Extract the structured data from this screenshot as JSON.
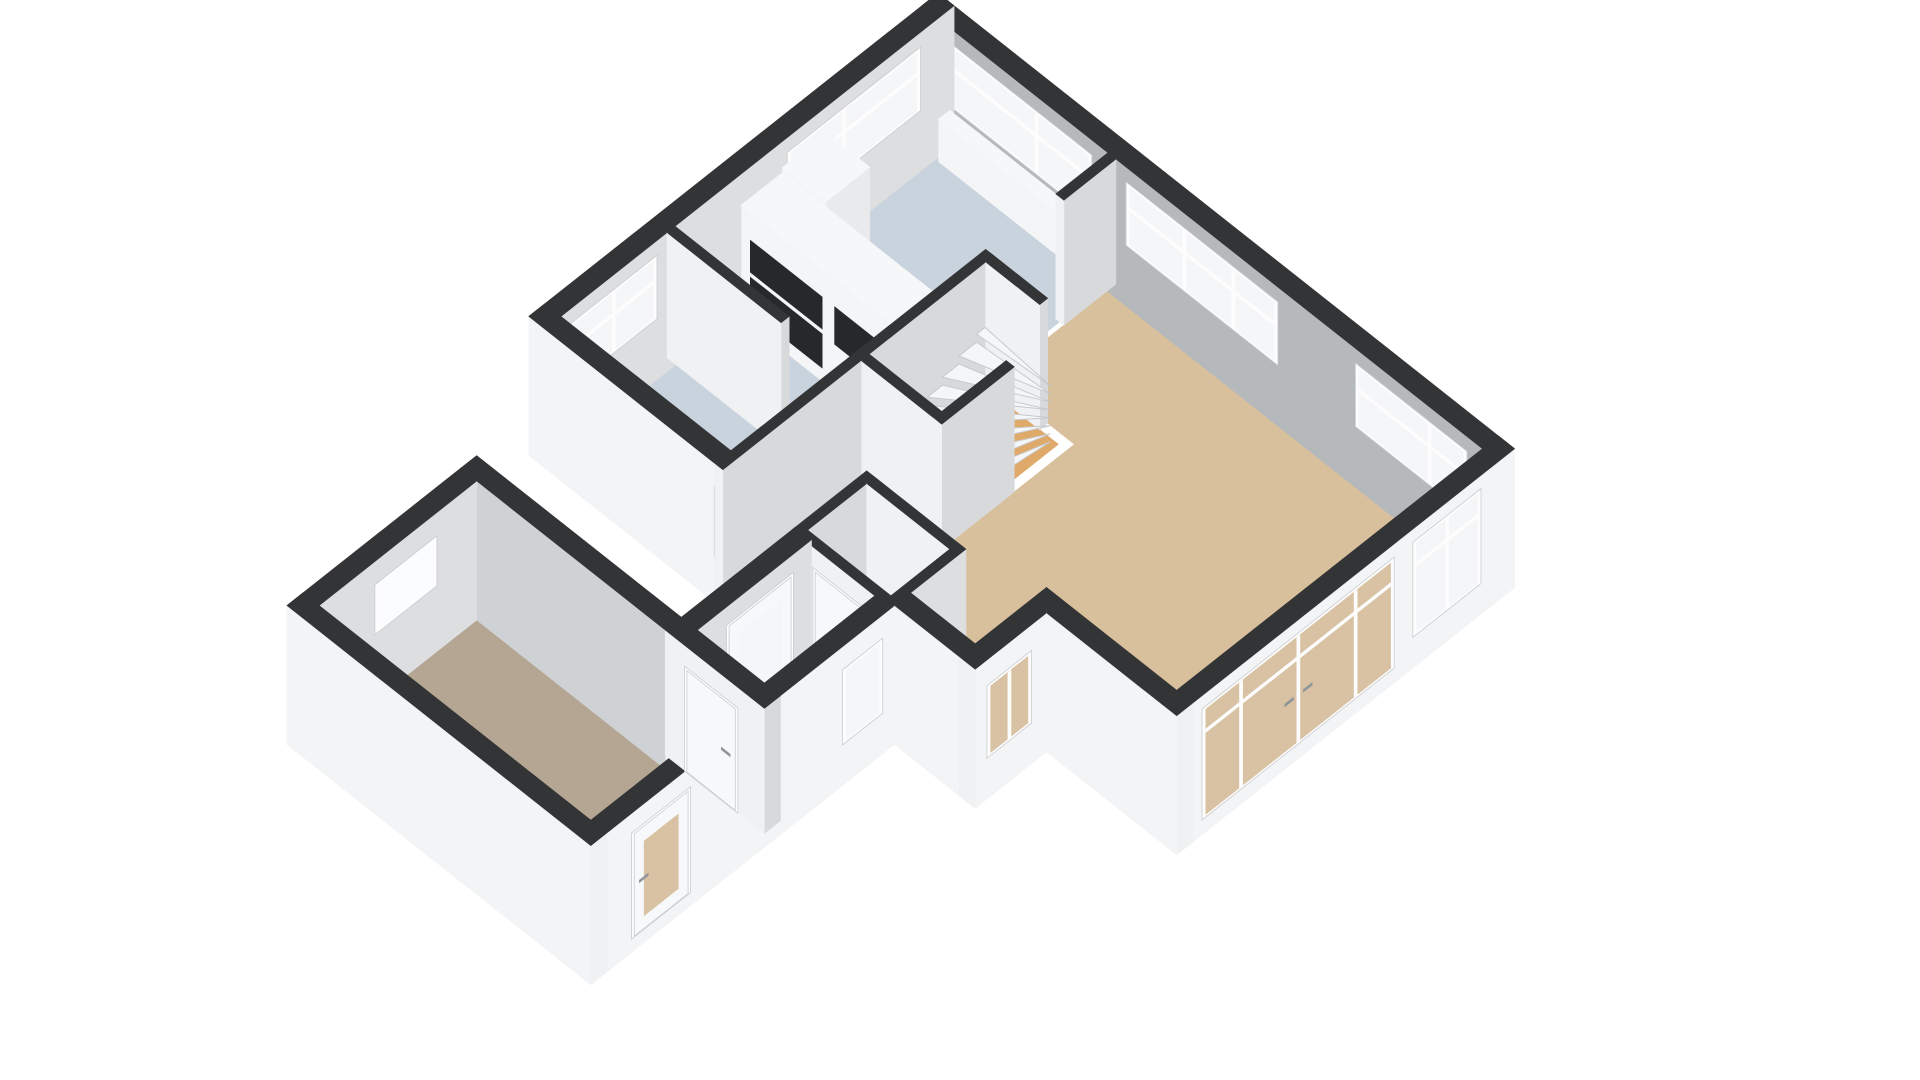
{
  "meta": {
    "type": "3d-floorplan-render",
    "view": "isometric-from-south-west",
    "background": "#ffffff",
    "floor_shown": "ground-floor"
  },
  "palette": {
    "wall_top": "#333436",
    "exterior_wall": "#f3f4f5",
    "exterior_wall_end": "#f0f1f2",
    "interior_shadow": "#b6b9bc",
    "interior_light": "#dcdee0",
    "partition_lit": "#f0f1f2",
    "partition_shade": "#d7d9db",
    "garage_interior": "#cfd2d4",
    "floor_living": "#d9c09c",
    "floor_wet": "#c9d3de",
    "floor_stairs": "#dfa96a",
    "floor_garage": "#b5a693",
    "glass_clear": "#f4f6f8",
    "glass_bright": "#fbfcfd",
    "glass_tan": "#d8c2a3",
    "glass_dark": "#41464b",
    "frame": "#fdfdfe",
    "frame_stroke": "#c9ccce",
    "door_panel": "#f7f8f9",
    "handle": "#8e9499",
    "tread": "#f5f6f7",
    "tread_stroke": "#c6c9cc",
    "cabinet_front": "#f4f5f6",
    "cabinet_side": "#e8eaec",
    "cabinet_top": "#f6f7f8",
    "appliance_dark": "#26282a"
  },
  "scene": {
    "projection": {
      "ox": 938,
      "oy": 118,
      "ax": 0.62,
      "by": 0.49,
      "cz": 0.5,
      "wall_h": 250,
      "slab": -28
    },
    "rooms": [
      {
        "name": "living-room",
        "floor": "floor_living"
      },
      {
        "name": "kitchen",
        "floor": "floor_wet"
      },
      {
        "name": "pantry",
        "floor": "floor_wet"
      },
      {
        "name": "hallway",
        "floor": "floor_wet"
      },
      {
        "name": "entry-hall",
        "floor": "floor_wet"
      },
      {
        "name": "toilet",
        "floor": "floor_wet"
      },
      {
        "name": "stairwell",
        "floor": "floor_stairs"
      },
      {
        "name": "garage",
        "floor": "floor_garage"
      }
    ],
    "floors": [
      {
        "name": "floor-living-room",
        "color": "floor_living",
        "pts": [
          [
            313,
            26
          ],
          [
            904,
            26
          ],
          [
            904,
            519
          ],
          [
            694,
            519
          ],
          [
            694,
            634
          ],
          [
            590,
            634
          ],
          [
            590,
            545
          ],
          [
            443,
            545
          ],
          [
            443,
            223
          ],
          [
            313,
            223
          ]
        ]
      },
      {
        "name": "floor-kitchen",
        "color": "floor_wet",
        "pts": [
          [
            26,
            26
          ],
          [
            306,
            26
          ],
          [
            306,
            450
          ],
          [
            26,
            450
          ]
        ]
      },
      {
        "name": "floor-pantry",
        "color": "floor_wet",
        "pts": [
          [
            26,
            463
          ],
          [
            306,
            463
          ],
          [
            306,
            634
          ],
          [
            26,
            634
          ]
        ]
      },
      {
        "name": "floor-hallway",
        "color": "floor_wet",
        "pts": [
          [
            313,
            437
          ],
          [
            430,
            437
          ],
          [
            430,
            634
          ],
          [
            313,
            634
          ]
        ]
      },
      {
        "name": "floor-entry-hall",
        "color": "floor_wet",
        "pts": [
          [
            456,
            666
          ],
          [
            577,
            666
          ],
          [
            577,
            844
          ],
          [
            456,
            844
          ]
        ]
      },
      {
        "name": "floor-toilet",
        "color": "floor_wet",
        "pts": [
          [
            443,
            558
          ],
          [
            577,
            558
          ],
          [
            577,
            653
          ],
          [
            443,
            653
          ]
        ]
      },
      {
        "name": "floor-stairwell",
        "color": "floor_stairs",
        "pts": [
          [
            313,
            236
          ],
          [
            430,
            236
          ],
          [
            430,
            424
          ],
          [
            313,
            424
          ]
        ]
      },
      {
        "name": "floor-garage",
        "color": "floor_garage",
        "pts": [
          [
            126,
            870
          ],
          [
            564,
            870
          ],
          [
            564,
            1124
          ],
          [
            126,
            1124
          ]
        ]
      }
    ],
    "walls": [
      {
        "name": "wall-ne-exterior",
        "x1": 0,
        "y1": 0,
        "x2": 930,
        "y2": 26,
        "ext": true,
        "se": "exterior_wall_end",
        "sw": "interior_shadow",
        "openings": [
          {
            "name": "window-ne-1",
            "type": "window",
            "plane": "y",
            "u1": 45,
            "u2": 275,
            "z1": 95,
            "z2": 222,
            "glass": "glass_clear",
            "bars": [
              0.62
            ],
            "transom": true
          },
          {
            "name": "window-ne-2",
            "type": "window",
            "plane": "y",
            "u1": 330,
            "u2": 575,
            "z1": 95,
            "z2": 222,
            "glass": "glass_clear",
            "bars": [
              0.38,
              0.72
            ],
            "transom": true
          },
          {
            "name": "window-ne-3",
            "type": "window",
            "plane": "y",
            "u1": 700,
            "u2": 880,
            "z1": 95,
            "z2": 222,
            "glass": "glass_clear",
            "bars": [
              0.68
            ],
            "transom": true
          }
        ]
      },
      {
        "name": "wall-nw-exterior",
        "x1": 0,
        "y1": 0,
        "x2": 26,
        "y2": 660,
        "ext": true,
        "se": "interior_light",
        "sw": "exterior_wall",
        "openings": [
          {
            "name": "window-kitchen",
            "type": "window",
            "plane": "x",
            "u1": 55,
            "u2": 270,
            "z1": 95,
            "z2": 222,
            "glass": "glass_clear",
            "bars": [
              0.58
            ],
            "transom": true
          },
          {
            "name": "window-pantry",
            "type": "window",
            "plane": "x",
            "u1": 480,
            "u2": 620,
            "z1": 95,
            "z2": 222,
            "glass": "glass_clear",
            "bars": [
              0.5
            ],
            "transom": true
          }
        ]
      },
      {
        "name": "wall-se-exterior",
        "x1": 904,
        "y1": 0,
        "x2": 930,
        "y2": 545,
        "ext": true,
        "se": "exterior_wall",
        "sw": "exterior_wall_end",
        "openings": [
          {
            "name": "window-se-tall",
            "type": "window",
            "plane": "x",
            "u1": 55,
            "u2": 165,
            "z1": 35,
            "z2": 225,
            "glass": "glass_clear",
            "bars": [
              0.5
            ],
            "transom": true
          },
          {
            "name": "french-doors",
            "type": "window",
            "plane": "x",
            "u1": 195,
            "u2": 505,
            "z1": 3,
            "z2": 225,
            "glass": "glass_tan",
            "bars": [
              0.19,
              0.5,
              0.81
            ],
            "transom": true,
            "handles": true
          }
        ]
      },
      {
        "name": "wall-bay-se",
        "x1": 694,
        "y1": 545,
        "x2": 720,
        "y2": 660,
        "ext": true,
        "se": "exterior_wall",
        "sw": "exterior_wall_end",
        "openings": [
          {
            "name": "window-bay",
            "type": "window",
            "plane": "x",
            "u1": 570,
            "u2": 642,
            "z1": 55,
            "z2": 200,
            "glass": "glass_tan",
            "bars": [
              0.5
            ]
          }
        ]
      },
      {
        "name": "wall-bay-sw",
        "x1": 590,
        "y1": 634,
        "x2": 720,
        "y2": 660,
        "ext": true,
        "se": "exterior_wall_end",
        "sw": "exterior_wall",
        "openings": []
      },
      {
        "name": "wall-living-sw",
        "x1": 694,
        "y1": 519,
        "x2": 930,
        "y2": 545,
        "ext": true,
        "se": "exterior_wall_end",
        "sw": "exterior_wall",
        "openings": []
      },
      {
        "name": "wall-hall-garage-se",
        "x1": 564,
        "y1": 660,
        "x2": 590,
        "y2": 1150,
        "ext": true,
        "se": "exterior_wall",
        "sw": "exterior_wall_end",
        "openings": [
          {
            "name": "window-hall-narrow",
            "type": "window",
            "plane": "x",
            "u1": 680,
            "u2": 745,
            "z1": 55,
            "z2": 205,
            "glass": "glass_clear"
          },
          {
            "name": "door-garage-exterior",
            "type": "door",
            "plane": "x",
            "u1": 990,
            "u2": 1085,
            "z1": 0,
            "z2": 212,
            "glass": "glass_tan",
            "glassInset": true,
            "handle": true
          }
        ]
      },
      {
        "name": "wall-garage-sw",
        "x1": 100,
        "y1": 1124,
        "x2": 590,
        "y2": 1150,
        "ext": true,
        "se": "exterior_wall_end",
        "sw": "exterior_wall",
        "openings": []
      },
      {
        "name": "wall-garage-nw",
        "x1": 100,
        "y1": 870,
        "x2": 126,
        "y2": 1150,
        "ext": true,
        "se": "interior_light",
        "sw": "exterior_wall",
        "openings": [
          {
            "name": "window-garage",
            "type": "window",
            "plane": "x",
            "u1": 935,
            "u2": 1035,
            "z1": 105,
            "z2": 205,
            "glass": "glass_bright"
          }
        ]
      },
      {
        "name": "wall-garage-ne-exterior",
        "x1": 100,
        "y1": 844,
        "x2": 430,
        "y2": 870,
        "ext": true,
        "se": "exterior_wall_end",
        "sw": "garage_interior",
        "openings": []
      },
      {
        "name": "wall-garage-door",
        "x1": 430,
        "y1": 844,
        "x2": 590,
        "y2": 870,
        "ext": false,
        "se": "partition_shade",
        "sw": "partition_lit",
        "openings": [
          {
            "name": "door-garage-interior",
            "type": "door",
            "plane": "y",
            "u1": 462,
            "u2": 548,
            "z1": 0,
            "z2": 210,
            "handle": true
          }
        ]
      },
      {
        "name": "wall-front-entry",
        "x1": 430,
        "y1": 660,
        "x2": 456,
        "y2": 844,
        "ext": true,
        "se": "interior_light",
        "sw": "exterior_wall",
        "openings": [
          {
            "name": "front-door",
            "type": "door",
            "plane": "x",
            "u1": 690,
            "u2": 798,
            "z1": 0,
            "z2": 215,
            "glass": "glass_clear",
            "glassInset": true,
            "handle": true
          }
        ]
      },
      {
        "name": "wall-kitchen-sw",
        "x1": 0,
        "y1": 634,
        "x2": 430,
        "y2": 660,
        "ext": true,
        "se": "exterior_wall_end",
        "sw": "exterior_wall",
        "openings": [
          {
            "name": "window-dark-entry",
            "type": "darkwindow",
            "plane": "y",
            "u1": 300,
            "u2": 398,
            "z1": 65,
            "z2": 205,
            "glass": "glass_dark"
          }
        ]
      },
      {
        "name": "wall-kitchen-stub",
        "x1": 300,
        "y1": 26,
        "x2": 313,
        "y2": 110,
        "ext": false,
        "se": "partition_shade",
        "sw": "partition_lit",
        "openings": []
      },
      {
        "name": "wall-stair-nw",
        "x1": 300,
        "y1": 223,
        "x2": 313,
        "y2": 437,
        "ext": false,
        "se": "partition_shade",
        "sw": "partition_lit",
        "openings": []
      },
      {
        "name": "wall-stair-ne",
        "x1": 313,
        "y1": 223,
        "x2": 400,
        "y2": 236,
        "ext": false,
        "se": "partition_shade",
        "sw": "partition_lit",
        "openings": []
      },
      {
        "name": "wall-stair-se",
        "x1": 430,
        "y1": 320,
        "x2": 443,
        "y2": 437,
        "ext": false,
        "se": "partition_shade",
        "sw": "partition_lit",
        "openings": []
      },
      {
        "name": "wall-stair-sw",
        "x1": 313,
        "y1": 424,
        "x2": 443,
        "y2": 437,
        "ext": false,
        "se": "partition_shade",
        "sw": "partition_lit",
        "openings": []
      },
      {
        "name": "wall-kitchen-east",
        "x1": 300,
        "y1": 437,
        "x2": 313,
        "y2": 660,
        "ext": false,
        "se": "partition_shade",
        "sw": "partition_lit",
        "openings": []
      },
      {
        "name": "wall-pantry-divider",
        "x1": 26,
        "y1": 450,
        "x2": 210,
        "y2": 463,
        "ext": false,
        "se": "partition_shade",
        "sw": "partition_lit",
        "openings": []
      },
      {
        "name": "wall-toilet-nw",
        "x1": 430,
        "y1": 545,
        "x2": 443,
        "y2": 653,
        "ext": false,
        "se": "partition_shade",
        "sw": "partition_lit",
        "openings": []
      },
      {
        "name": "wall-toilet-ne",
        "x1": 443,
        "y1": 545,
        "x2": 590,
        "y2": 558,
        "ext": false,
        "se": "partition_shade",
        "sw": "partition_lit",
        "openings": []
      },
      {
        "name": "wall-toilet-se",
        "x1": 577,
        "y1": 545,
        "x2": 590,
        "y2": 666,
        "ext": false,
        "se": "interior_light",
        "sw": "partition_lit",
        "openings": []
      },
      {
        "name": "wall-toilet-door",
        "x1": 430,
        "y1": 653,
        "x2": 577,
        "y2": 666,
        "ext": false,
        "se": "partition_shade",
        "sw": "partition_lit",
        "openings": [
          {
            "name": "door-toilet",
            "type": "door",
            "plane": "y",
            "u1": 465,
            "u2": 550,
            "z1": 0,
            "z2": 210,
            "handle": true
          }
        ]
      }
    ],
    "furniture": [
      {
        "name": "kitchen-cabinet-corner",
        "x1": 45,
        "y1": 225,
        "x2": 115,
        "y2": 296,
        "zt": 235,
        "se": "cabinet_side",
        "sw": "cabinet_front",
        "top": "cabinet_top",
        "panels": []
      },
      {
        "name": "kitchen-cabinet-ovens",
        "x1": 45,
        "y1": 296,
        "x2": 185,
        "y2": 362,
        "zt": 225,
        "se": "cabinet_side",
        "sw": "cabinet_front",
        "top": "cabinet_top",
        "panels": [
          {
            "name": "appliance-oven-lower",
            "u1": 60,
            "z1": 28,
            "u2": 176,
            "z2": 96
          },
          {
            "name": "appliance-oven-upper",
            "u1": 60,
            "z1": 106,
            "u2": 176,
            "z2": 170
          }
        ]
      },
      {
        "name": "kitchen-cabinet-fridge",
        "x1": 185,
        "y1": 296,
        "x2": 300,
        "y2": 362,
        "zt": 225,
        "se": "cabinet_side",
        "sw": "cabinet_front",
        "top": "cabinet_top",
        "panels": [
          {
            "name": "appliance-fridge-front",
            "u1": 196,
            "z1": 95,
            "u2": 290,
            "z2": 170
          }
        ]
      },
      {
        "name": "window-sill-ledge",
        "x1": 45,
        "y1": 26,
        "x2": 275,
        "y2": 44,
        "zt": 85,
        "se": "cabinet_side",
        "sw": "cabinet_front",
        "top": "cabinet_top",
        "panels": []
      }
    ],
    "stairs": {
      "name": "winder-staircase",
      "px": 428,
      "py": 247,
      "r": 142,
      "a0": 96,
      "a1": 189,
      "n": 8,
      "z0": 14,
      "dz": 16,
      "clampx": 316,
      "clampy": 240,
      "sortKey": 545
    }
  }
}
